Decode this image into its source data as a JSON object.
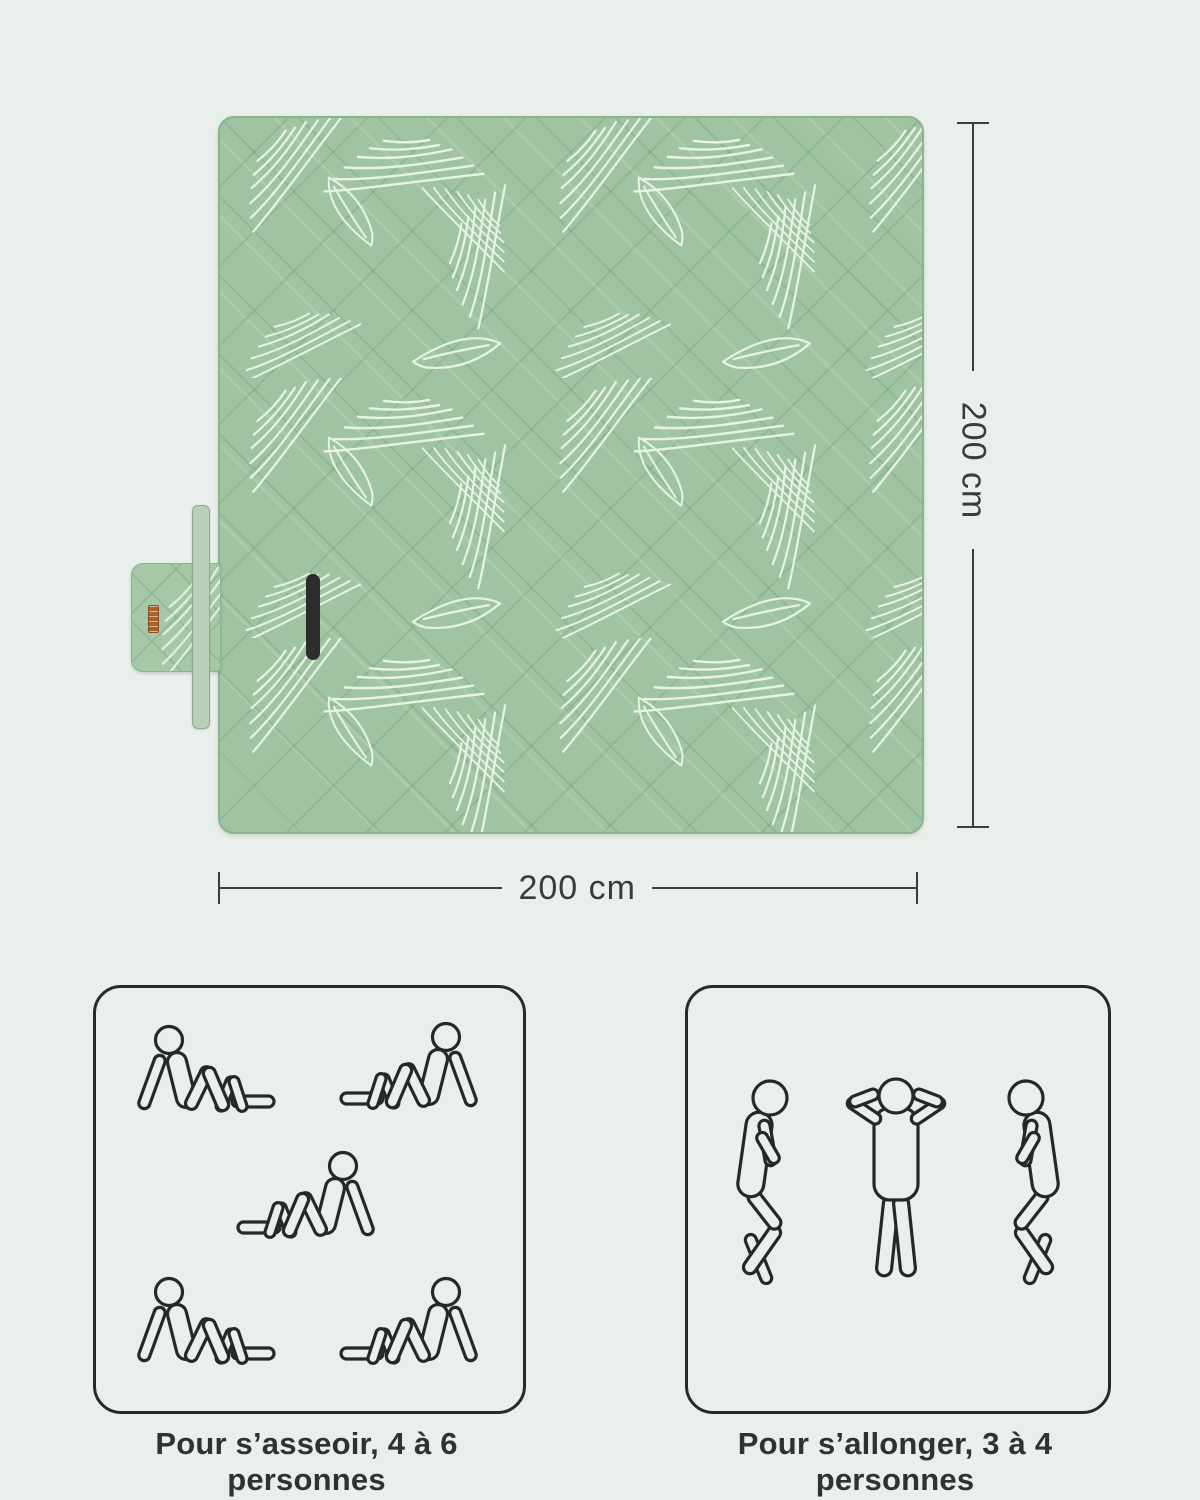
{
  "page": {
    "background_color": "#e9efeb"
  },
  "product": {
    "type": "picnic-blanket",
    "blanket_color": "#a0c4a1",
    "pattern_line_color": "#e7f3e5",
    "strap_color": "#b9cfb7",
    "handle_color": "#2d2d2d",
    "brand_tag_color": "#a85f28",
    "outline_color": "#24282a"
  },
  "dimension_labels": {
    "height": "200 cm",
    "width": "200 cm"
  },
  "capacity": {
    "sitting": {
      "caption": "Pour s’asseoir, 4 à 6 personnes",
      "figure_count": 5
    },
    "lying": {
      "caption": "Pour s’allonger, 3 à 4 personnes",
      "figure_count": 3
    }
  },
  "icons": {
    "sitting_person": "person-sitting-outline",
    "lying_person_side": "person-lying-on-side-outline",
    "lying_person_back": "person-lying-on-back-outline"
  }
}
